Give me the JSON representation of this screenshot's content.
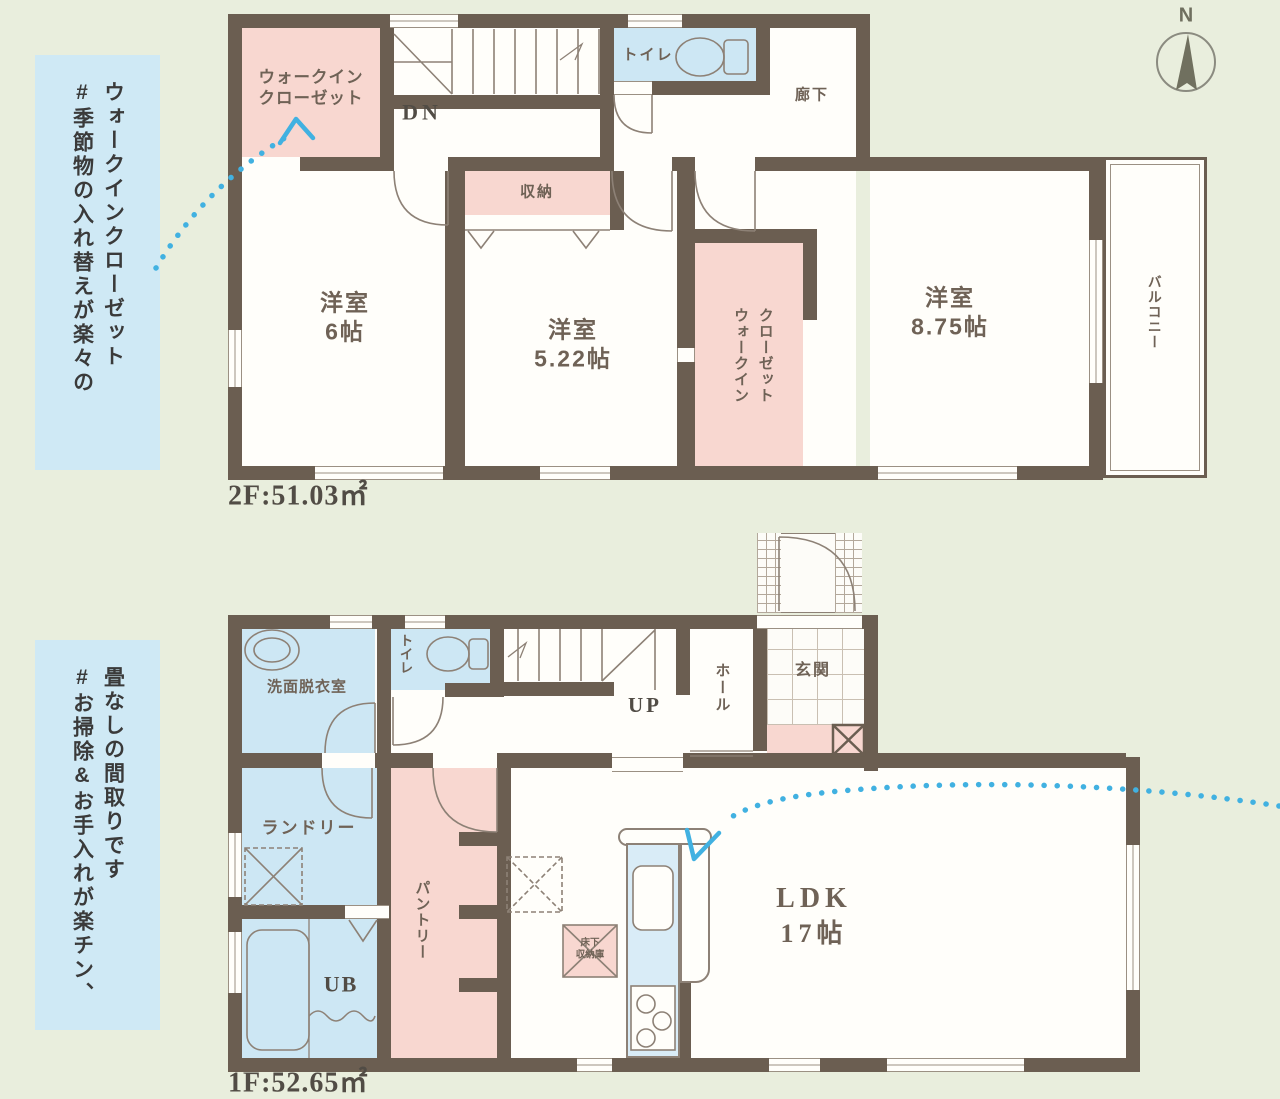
{
  "colors": {
    "wall": "#6b5e51",
    "pink": "#f8d7d0",
    "blue": "#cde7f4",
    "background": "#e9eedd",
    "callout_bg": "#cfe9f5",
    "arrow": "#41b1e1",
    "thin_line": "#8d8176",
    "room_text": "#6f6256",
    "dark_text": "#514c45"
  },
  "compass": {
    "north_label": "N"
  },
  "callouts": [
    {
      "column1": "#季節物の入れ替えが楽々の",
      "column2": "ウォークインクローゼット"
    },
    {
      "column1": "#お掃除&お手入れが楽チン、",
      "column2": "畳なしの間取りです"
    }
  ],
  "floor2": {
    "area_label": "2F:51.03㎡",
    "walk_in_closet_line1": "ウォークイン",
    "walk_in_closet_line2": "クローゼット",
    "stairs_label": "DN",
    "toilet": "トイレ",
    "corridor": "廊下",
    "storage": "収納",
    "bedroom_6": {
      "name": "洋室",
      "size": "6帖"
    },
    "bedroom_522": {
      "name": "洋室",
      "size": "5.22帖"
    },
    "walk_in_closet2_col1": "ウォークイン",
    "walk_in_closet2_col2": "クローゼット",
    "bedroom_875": {
      "name": "洋室",
      "size": "8.75帖"
    },
    "balcony": "バルコニー"
  },
  "floor1": {
    "area_label": "1F:52.65㎡",
    "washroom": "洗面脱衣室",
    "toilet": "トイレ",
    "stairs_label": "UP",
    "hall": "ホール",
    "entrance": "玄関",
    "laundry": "ランドリー",
    "pantry": "パントリー",
    "unit_bath": "UB",
    "ldk": {
      "name": "LDK",
      "size": "17帖"
    },
    "underfloor_storage_line1": "床下",
    "underfloor_storage_line2": "収納庫"
  }
}
